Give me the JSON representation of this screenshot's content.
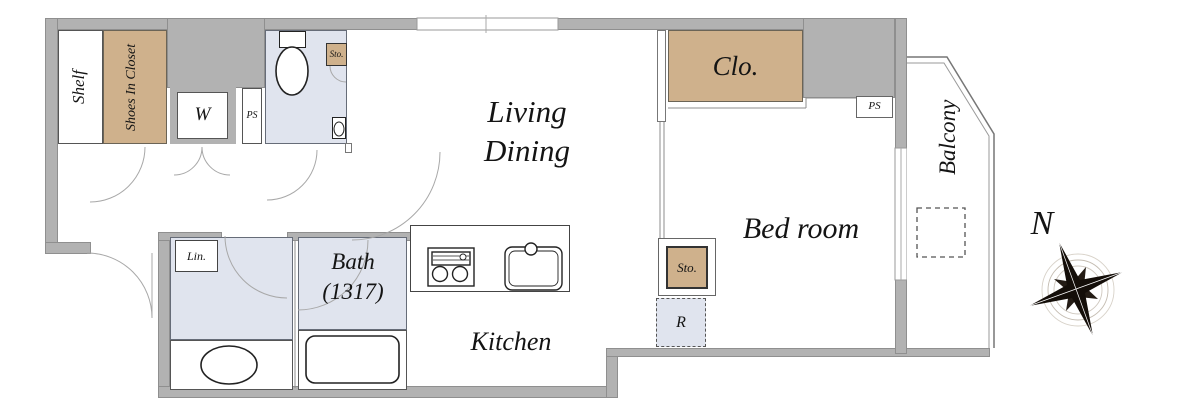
{
  "plan": {
    "title_hint": "apartment floor plan",
    "colors": {
      "wall": "#b2b2b2",
      "wood_storage": "#cfb18c",
      "wet_rooms": "#e0e4ee"
    },
    "entrance": {
      "shelf_label": "Shelf",
      "shoes_closet_label": "Shoes In Closet",
      "washer_label": "W",
      "pipe_space_label": "PS"
    },
    "toilet": {
      "storage_label": "Sto."
    },
    "living_dining": {
      "name_line1": "Living",
      "name_line2": "Dining"
    },
    "bedroom": {
      "name": "Bed room",
      "closet_label": "Clo.",
      "pipe_space_label": "PS",
      "storage_label": "Sto.",
      "refrigerator_label": "R"
    },
    "washroom": {
      "linen_label": "Lin."
    },
    "bath": {
      "name": "Bath",
      "size": "(1317)"
    },
    "kitchen": {
      "name": "Kitchen"
    },
    "balcony": {
      "name": "Balcony"
    },
    "compass": {
      "north_label": "N"
    }
  }
}
